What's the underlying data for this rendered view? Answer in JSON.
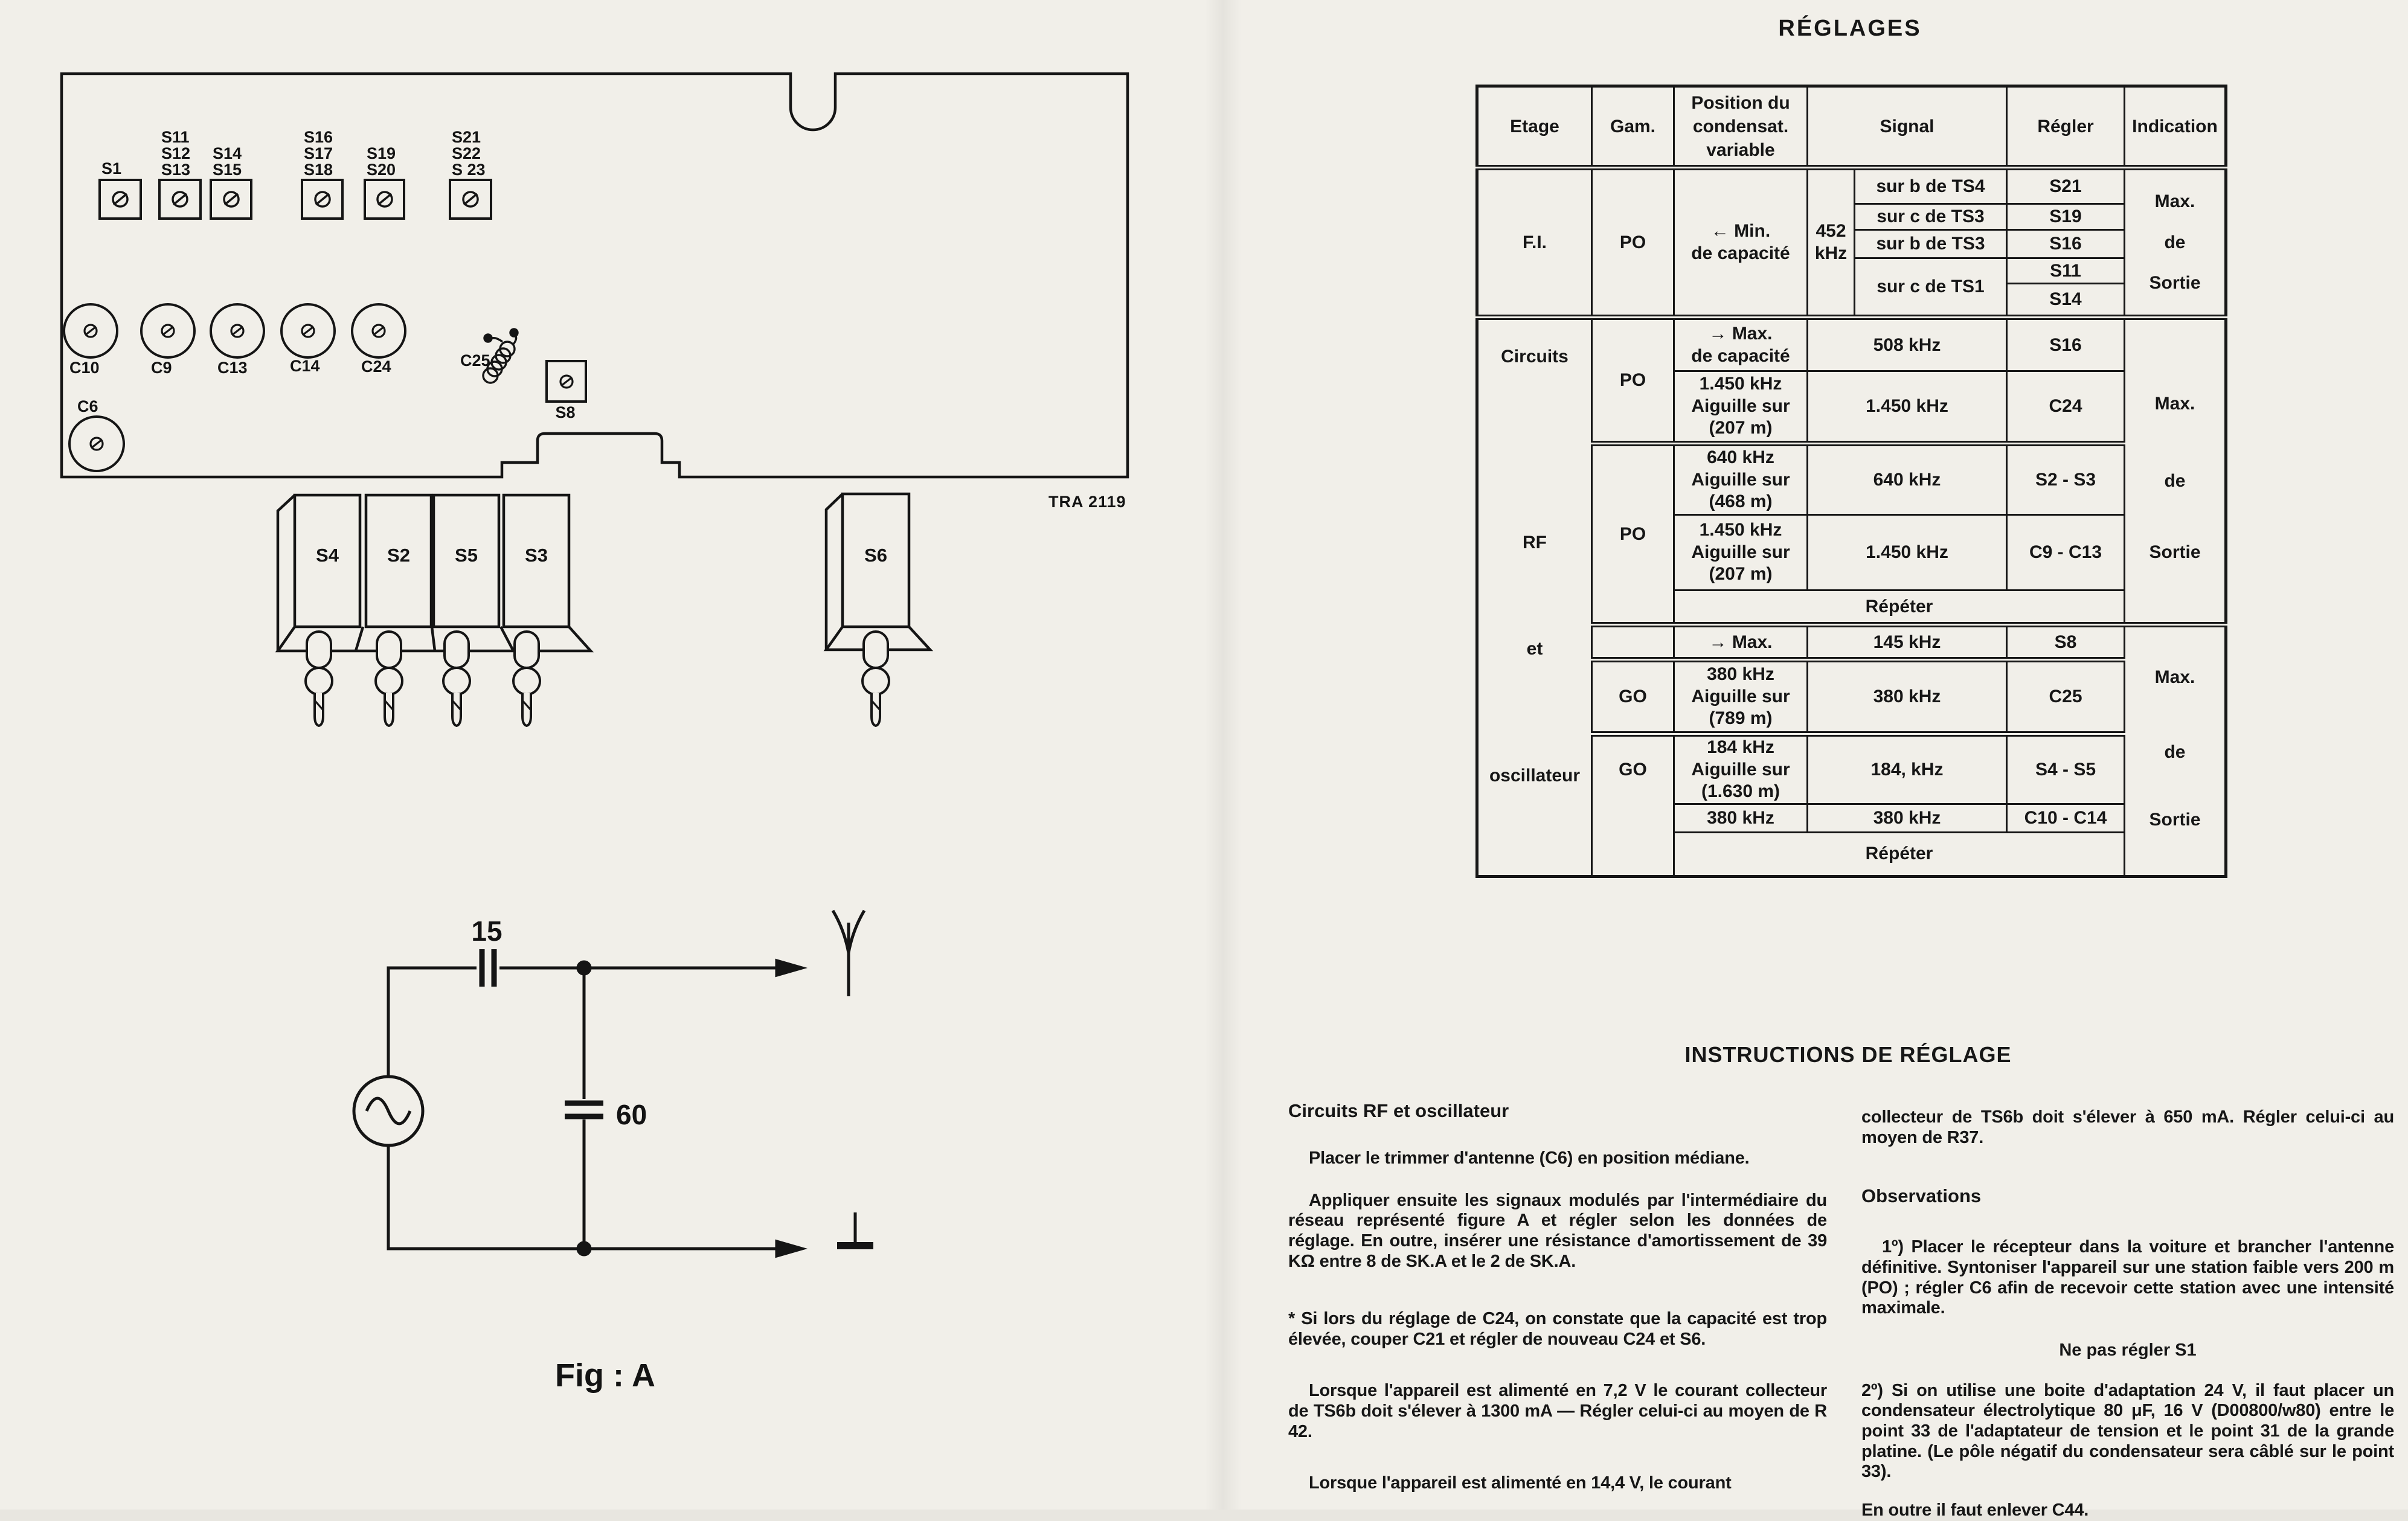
{
  "pcb": {
    "trimmer_groups": [
      [
        "S1"
      ],
      [
        "S11",
        "S12",
        "S13"
      ],
      [
        "S14",
        "S15"
      ],
      [
        "S16",
        "S17",
        "S18"
      ],
      [
        "S19",
        "S20"
      ],
      [
        "S21",
        "S22",
        "S 23"
      ]
    ],
    "cap_row": [
      "C10",
      "C9",
      "C13",
      "C14",
      "C24"
    ],
    "c25": "C25",
    "c6": "C6",
    "s8": "S8",
    "coils": [
      "S4",
      "S2",
      "S5",
      "S3"
    ],
    "s6": "S6",
    "part_number": "TRA 2119"
  },
  "figure": {
    "series_cap": "15",
    "shunt_cap": "60",
    "caption": "Fig : A"
  },
  "table": {
    "title": "RÉGLAGES",
    "headers": {
      "etage": "Etage",
      "gam": "Gam.",
      "position": "Position du\ncondensat.\nvariable",
      "signal": "Signal",
      "regler": "Régler",
      "indication": "Indication"
    },
    "fi": {
      "etage": "F.I.",
      "gam": "PO",
      "position": "← Min.\nde capacité",
      "freq": "452\nkHz",
      "r1": {
        "signal": "sur b de TS4",
        "regler": "S21"
      },
      "r2": {
        "signal": "sur c de TS3",
        "regler": "S19"
      },
      "r3": {
        "signal": "sur b de TS3",
        "regler": "S16"
      },
      "r4": {
        "signal": "sur c de TS1",
        "regler_a": "S11",
        "regler_b": "S14"
      },
      "indication": "Max.\nde\nSortie"
    },
    "etage_words": {
      "w1": "Circuits",
      "w2": "RF",
      "w3": "et",
      "w4": "oscillateur"
    },
    "mid": {
      "gam_a": "PO",
      "gam_b": "PO",
      "r508": {
        "position": "→ Max.\nde capacité",
        "signal": "508 kHz",
        "regler": "S16"
      },
      "r1450a": {
        "position": "1.450 kHz\nAiguille sur\n(207 m)",
        "signal": "1.450 kHz",
        "regler": "C24"
      },
      "r640": {
        "position": "640 kHz\nAiguille sur\n(468 m)",
        "signal": "640 kHz",
        "regler": "S2 - S3"
      },
      "r1450b": {
        "position": "1.450 kHz\nAiguille sur\n(207 m)",
        "signal": "1.450 kHz",
        "regler": "C9 - C13"
      },
      "repeat": "Répéter",
      "indication": {
        "w1": "Max.",
        "w2": "de",
        "w3": "Sortie"
      }
    },
    "bot": {
      "gam_a": "GO",
      "gam_b": "GO",
      "r145": {
        "position": "→ Max.",
        "signal": "145 kHz",
        "regler": "S8"
      },
      "r380a": {
        "position": "380 kHz\nAiguille sur\n(789 m)",
        "signal": "380 kHz",
        "regler": "C25"
      },
      "r184": {
        "position": "184 kHz\nAiguille sur\n(1.630 m)",
        "signal": "184, kHz",
        "regler": "S4 - S5"
      },
      "r380b": {
        "position": "380 kHz",
        "signal": "380 kHz",
        "regler": "C10 - C14"
      },
      "repeat": "Répéter",
      "indication": {
        "w1": "Max.",
        "w2": "de",
        "w3": "Sortie"
      }
    }
  },
  "instructions": {
    "title": "INSTRUCTIONS DE RÉGLAGE",
    "left": {
      "heading": "Circuits RF et oscillateur",
      "p1": "Placer le trimmer d'antenne (C6) en position médiane.",
      "p2": "Appliquer ensuite les signaux modulés par l'intermédiaire du réseau représenté figure A et régler selon les données de réglage. En outre, insérer une résistance d'amortissement de 39 KΩ entre 8 de SK.A et le 2 de SK.A.",
      "p3": "* Si lors du réglage de C24, on constate que la capacité est trop élevée, couper C21 et régler de nouveau C24 et S6.",
      "p4": "Lorsque l'appareil est alimenté en 7,2 V le courant collecteur de TS6b doit s'élever à 1300 mA — Régler celui-ci au moyen de R 42.",
      "p5": "Lorsque l'appareil est alimenté en 14,4 V, le courant"
    },
    "right": {
      "p0": "collecteur de TS6b doit s'élever à 650 mA. Régler celui-ci au moyen de R37.",
      "heading": "Observations",
      "p1": "1º) Placer le récepteur dans la voiture et brancher l'antenne définitive. Syntoniser l'appareil sur une station faible vers 200 m (PO) ; régler C6 afin de recevoir cette station avec une intensité maximale.",
      "note": "Ne pas régler S1",
      "p2": "2º) Si on utilise une boite d'adaptation 24 V, il faut placer un condensateur électrolytique 80 μF, 16 V (D00800/w80) entre le point 33 de l'adaptateur de tension et le point 31 de la grande platine. (Le pôle négatif du condensateur sera câblé sur le point 33).",
      "p3": "En outre il faut enlever C44."
    }
  }
}
